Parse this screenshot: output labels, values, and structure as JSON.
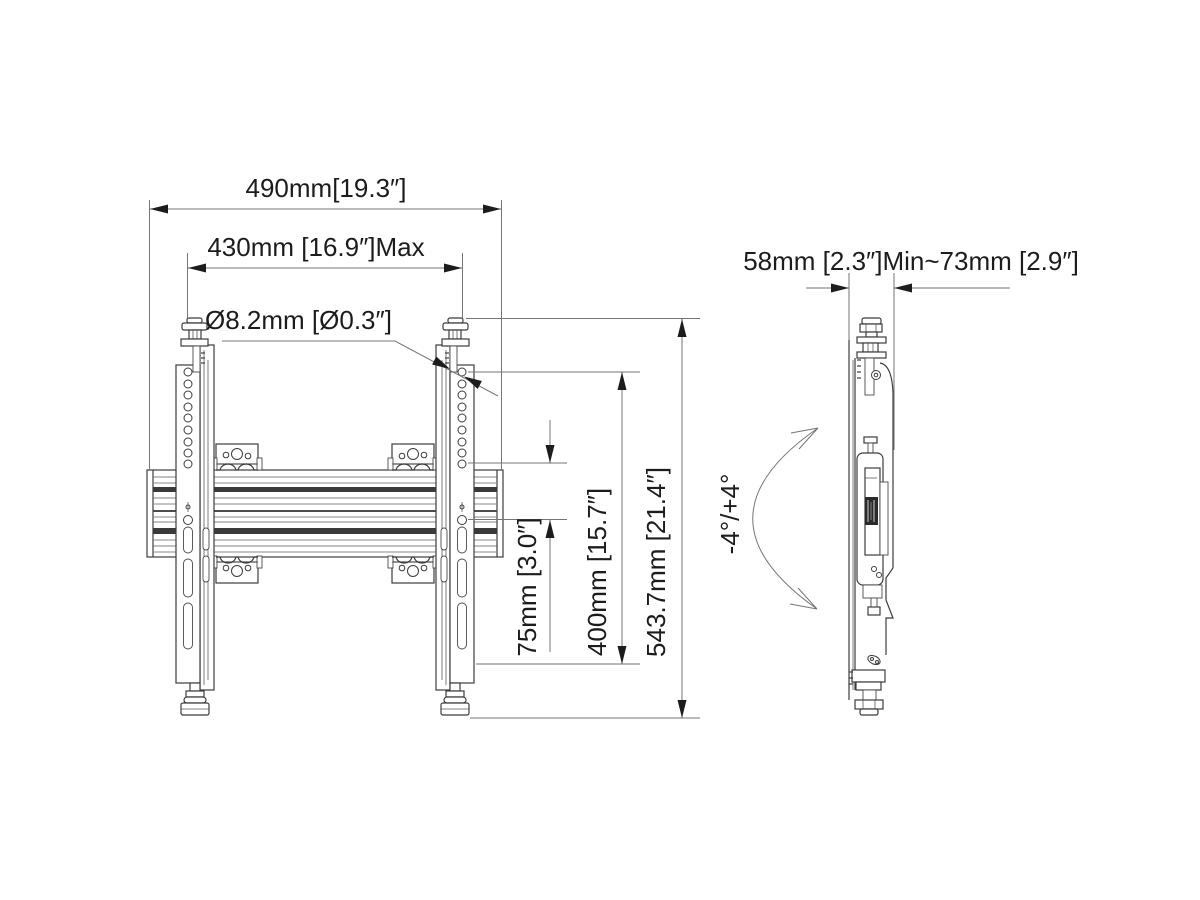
{
  "drawing": {
    "type": "technical-dimension-drawing",
    "front_view": {
      "dim_width_overall": "490mm[19.3″]",
      "dim_width_max": "430mm [16.9″]Max",
      "dim_hole_diameter": "Ø8.2mm [Ø0.3″]",
      "dim_hole_pitch": "75mm [3.0″]",
      "dim_vesa_height": "400mm [15.7″]",
      "dim_height_overall": "543.7mm [21.4″]"
    },
    "side_view": {
      "dim_depth_range": "58mm [2.3″]Min~73mm [2.9″]",
      "tilt_range": "-4°/+4°"
    },
    "colors": {
      "background": "#ffffff",
      "body_line": "#3c3c3c",
      "dimension_line": "#757575",
      "text": "#1c1c1c"
    }
  }
}
